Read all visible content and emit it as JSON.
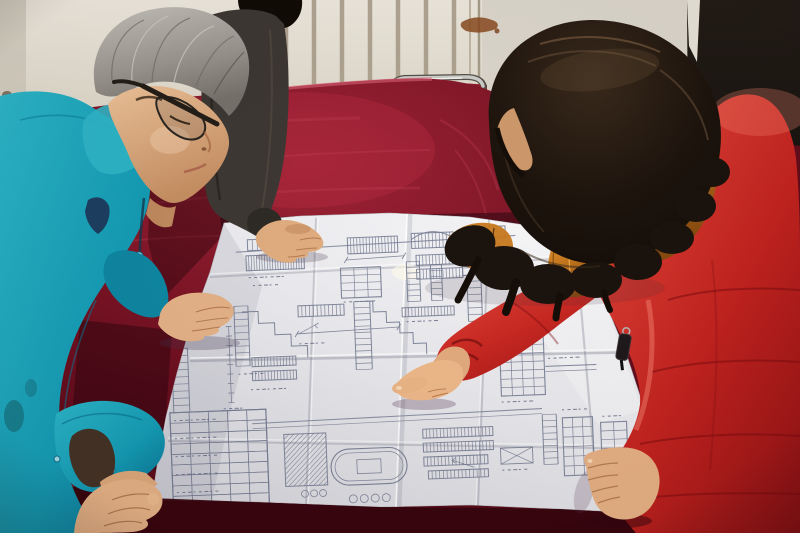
{
  "scene": {
    "description": "Photograph: three people gather around a table draped in dark red velvet to study a large folded engineering blueprint. A gray-haired man in a bright teal work jacket and dark glasses leans over the sheet at left, a colleague in a dark jacket rests a hand on the drawing at top, and a woman with long dark wavy hair wearing a red down coat with an orange fur-trimmed hood points at a detail on the plan.",
    "setting": "Room with an off-white wall, a white radiator with vertical fins, a pale door panel with a rust stain, a dark open doorway at right, and a metal-framed chair behind the table.",
    "people": [
      {
        "id": "man-in-teal",
        "description": "Middle-aged man, gray hair, dark-rimmed glasses, bright teal work jacket with snap buttons, leaning on the blueprint with both hands"
      },
      {
        "id": "colleague-in-dark-jacket",
        "description": "Partially visible person in a dark brown-gray jacket with black hair, one hand resting on the top edge of the blueprint"
      },
      {
        "id": "woman-in-red",
        "description": "Woman with long dark wavy hair, red quilted down coat with orange fur hood trim and a black zipper pull, pointing at the blueprint with her right hand, left hand resting on the sheet"
      }
    ],
    "objects": [
      {
        "id": "blueprint-sheet",
        "description": "Large folded white structural drawing sheet covered in small schedules, ladder-like rebar details, dimension strings, a hatched section, a stadium-shaped detail and a data table; no text is legible"
      },
      {
        "id": "velvet-tablecloth",
        "description": "Dark crimson velvet cloth covering the table, brighter at the top edge, nearly black at the front edge"
      },
      {
        "id": "radiator",
        "description": "White wall radiator with evenly spaced vertical fins"
      },
      {
        "id": "chair-frame",
        "description": "Chrome tube of a chair back with a red seat, just visible above the table edge"
      },
      {
        "id": "dark-doorway",
        "description": "Unlit dark opening at the right side of the room"
      },
      {
        "id": "rust-stain",
        "description": "Small brown rust smear on the pale door panel"
      }
    ],
    "text_visible": "none legible"
  },
  "palette": {
    "wall": "#e8e3d8",
    "radiator_line": "#ab9f8a",
    "door_panel": "#ddd8cd",
    "doorway_dark": "#17120e",
    "rust": "#8a4a1e",
    "chrome": "#cdcdc9",
    "velvet": "#7c1322",
    "velvet_highlight": "#a93b4e",
    "velvet_shadow": "#3a060f",
    "paper": "#ececef",
    "blueprint_ink": "#767c92",
    "teal_jacket": "#149cb5",
    "teal_shadow": "#0b7d9b",
    "skin": "#e3b085",
    "gray_hair": "#a09c95",
    "black_hair": "#17100b",
    "dark_jacket": "#3d3833",
    "coat_red": "#c4231f",
    "coat_highlight": "#ee5b4a",
    "coat_shadow": "#8e1114",
    "fur_trim": "#c8791e"
  }
}
